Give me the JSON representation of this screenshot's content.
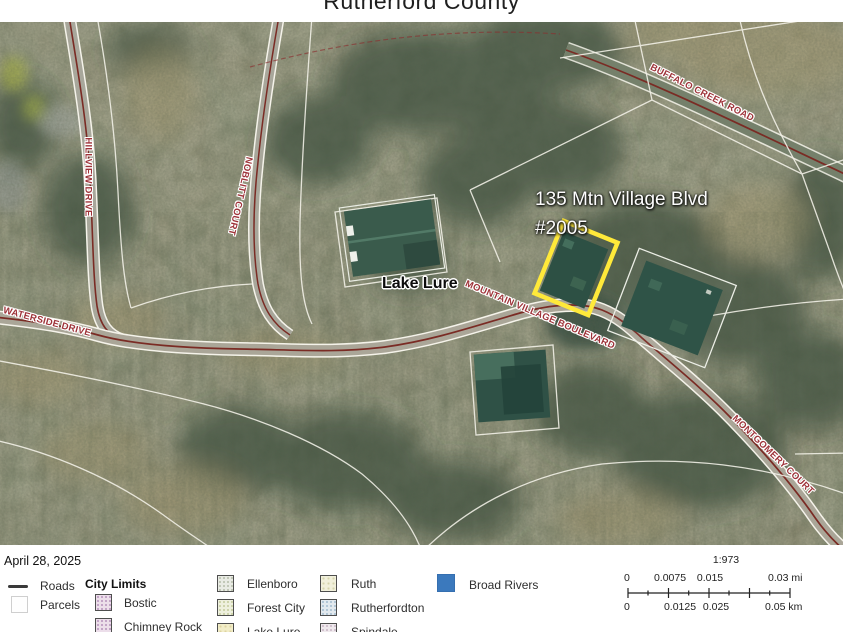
{
  "title": "Rutherford County",
  "map": {
    "annotation": {
      "line1": "135 Mtn Village Blvd",
      "line2": "#2005"
    },
    "place_label": "Lake Lure",
    "roads": {
      "hillview": "HILLVIEW DRIVE",
      "noblitt": "NOBLITT COURT",
      "waterside": "WATERSIDE DRIVE",
      "buffalo": "BUFFALO CREEK ROAD",
      "mountain_village": "MOUNTAIN VILLAGE BOULEVARD",
      "montgomery": "MONTGOMERY COURT"
    }
  },
  "legend": {
    "date": "April 28, 2025",
    "roads": "Roads",
    "parcels": "Parcels",
    "city_limits": "City Limits",
    "cities": {
      "bostic": "Bostic",
      "chimney_rock": "Chimney Rock",
      "ellenboro": "Ellenboro",
      "forest_city": "Forest City",
      "lake_lure": "Lake Lure",
      "ruth": "Ruth",
      "rutherfordton": "Rutherfordton",
      "spindale": "Spindale"
    },
    "broad_rivers": "Broad Rivers"
  },
  "scalebar": {
    "ratio": "1:973",
    "mi": [
      "0",
      "0.0075",
      "0.015",
      "0.03 mi"
    ],
    "km": [
      "0",
      "0.0125",
      "0.025",
      "0.05 km"
    ]
  },
  "colors": {
    "parcel_highlight": "#ffe93a",
    "road_label": "#9e3339",
    "road_centerline": "#7a2b24",
    "broad_rivers": "#3b79bd"
  }
}
